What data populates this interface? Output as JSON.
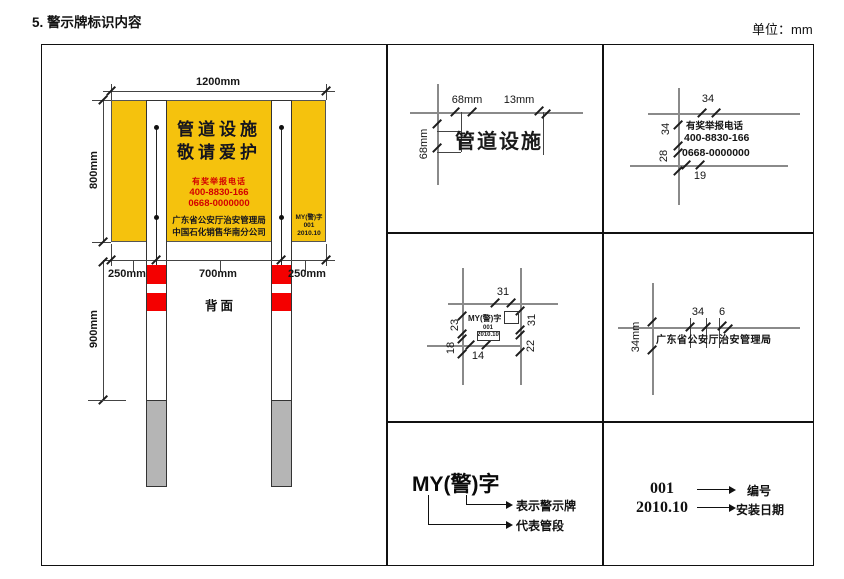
{
  "page": {
    "title": "5. 警示牌标识内容",
    "unit": "单位：mm"
  },
  "colors": {
    "sign_yellow": "#F5C20D",
    "stripe_red": "#F40000",
    "buried_gray": "#B5B5B5",
    "hotline_red": "#D40000",
    "text_dark": "#14141e"
  },
  "main_drawing": {
    "dims": {
      "width": "1200mm",
      "height": "800mm",
      "left": "250mm",
      "center": "700mm",
      "right": "250mm",
      "post": "900mm"
    },
    "back_label": "背面",
    "sign": {
      "line1": "管道设施",
      "line2": "敬请爱护",
      "hotline_label": "有奖举报电话",
      "phone1": "400-8830-166",
      "phone2": "0668-0000000",
      "org1": "广东省公安厅治安管理局",
      "org2": "中国石化销售华南分公司",
      "code1": "MY(警)字",
      "code2": "001",
      "code3": "2010.10"
    }
  },
  "detail_title_text": {
    "text": "管道设施",
    "dim_char_width": "68mm",
    "dim_gap": "13mm",
    "dim_char_height": "68mm"
  },
  "detail_hotline": {
    "line1": "有奖举报电话",
    "line2": "400-8830-166",
    "line3": "0668-0000000",
    "dim_top": "34",
    "dim_left_upper": "34",
    "dim_left_lower": "28",
    "dim_bottom": "19"
  },
  "detail_code": {
    "line1": "MY(警)字",
    "line2": "001",
    "line3": "2010.10",
    "dim_top": "31",
    "dim_left_upper": "23",
    "dim_left_lower": "18",
    "dim_bottom": "14",
    "dim_right_upper": "31",
    "dim_right_lower": "22"
  },
  "detail_org": {
    "text": "广东省公安厅治安管理局",
    "dim_char": "34",
    "dim_gap": "6",
    "dim_height": "34mm"
  },
  "legend_code": {
    "code": "MY(警)字",
    "meaning_upper": "表示警示牌",
    "meaning_lower": "代表管段"
  },
  "legend_num": {
    "number": "001",
    "number_label": "编号",
    "date": "2010.10",
    "date_label": "安装日期"
  }
}
